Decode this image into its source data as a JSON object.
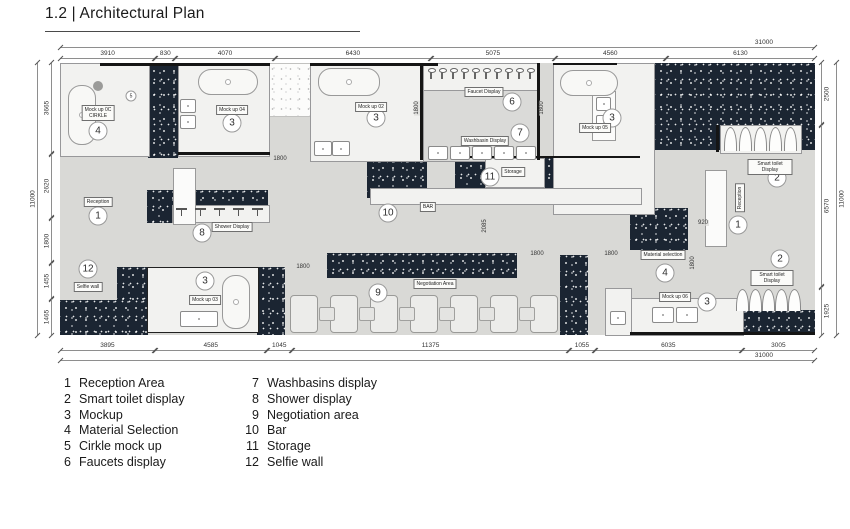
{
  "title": "1.2 | Architectural Plan",
  "colors": {
    "dark_fill": "#1b2532",
    "room_fill": "#f2f2f0",
    "corridor_fill": "#d9d9d6"
  },
  "dimensions": {
    "top": {
      "total": "31000",
      "segments": [
        {
          "label": "3910",
          "mm": 3910
        },
        {
          "label": "830",
          "mm": 830
        },
        {
          "label": "4070",
          "mm": 4070
        },
        {
          "label": "6430",
          "mm": 6430
        },
        {
          "label": "5075",
          "mm": 5075
        },
        {
          "label": "4560",
          "mm": 4560
        },
        {
          "label": "6130",
          "mm": 6130
        }
      ]
    },
    "bottom": {
      "total": "31000",
      "segments": [
        {
          "label": "3895",
          "mm": 3895
        },
        {
          "label": "4585",
          "mm": 4585
        },
        {
          "label": "1045",
          "mm": 1045
        },
        {
          "label": "11375",
          "mm": 11375
        },
        {
          "label": "1055",
          "mm": 1055
        },
        {
          "label": "6035",
          "mm": 6035
        },
        {
          "label": "3005",
          "mm": 3005
        }
      ]
    },
    "left": {
      "total": "11000",
      "segments": [
        {
          "label": "3665",
          "mm": 3665
        },
        {
          "label": "2620",
          "mm": 2620
        },
        {
          "label": "1800",
          "mm": 1800
        },
        {
          "label": "1455",
          "mm": 1455
        },
        {
          "label": "1465",
          "mm": 1465
        }
      ]
    },
    "right": {
      "total": "11000",
      "segments": [
        {
          "label": "2500",
          "mm": 2500
        },
        {
          "label": "6570",
          "mm": 6570
        },
        {
          "label": "1925",
          "mm": 1925
        }
      ]
    }
  },
  "plan_annotations": {
    "markers": [
      {
        "num": "4",
        "x": 38,
        "y": 68
      },
      {
        "num": "5",
        "x": 71,
        "y": 33,
        "small": true
      },
      {
        "num": "3",
        "x": 172,
        "y": 60
      },
      {
        "num": "3",
        "x": 316,
        "y": 55
      },
      {
        "num": "6",
        "x": 452,
        "y": 39
      },
      {
        "num": "7",
        "x": 460,
        "y": 70
      },
      {
        "num": "11",
        "x": 430,
        "y": 114
      },
      {
        "num": "10",
        "x": 328,
        "y": 150
      },
      {
        "num": "3",
        "x": 552,
        "y": 55
      },
      {
        "num": "2",
        "x": 717,
        "y": 115
      },
      {
        "num": "1",
        "x": 678,
        "y": 162
      },
      {
        "num": "2",
        "x": 720,
        "y": 196
      },
      {
        "num": "4",
        "x": 605,
        "y": 210
      },
      {
        "num": "3",
        "x": 647,
        "y": 239
      },
      {
        "num": "1",
        "x": 38,
        "y": 153
      },
      {
        "num": "8",
        "x": 142,
        "y": 170
      },
      {
        "num": "12",
        "x": 28,
        "y": 206
      },
      {
        "num": "9",
        "x": 318,
        "y": 230
      },
      {
        "num": "3",
        "x": 145,
        "y": 218
      }
    ],
    "room_labels": [
      {
        "text": "Mock up 0C\nCIRKLE",
        "x": 38,
        "y": 50
      },
      {
        "text": "Mock up 04",
        "x": 172,
        "y": 47
      },
      {
        "text": "Mock up 02",
        "x": 311,
        "y": 44
      },
      {
        "text": "Faucet Display",
        "x": 424,
        "y": 29
      },
      {
        "text": "Washbasin Display",
        "x": 425,
        "y": 78
      },
      {
        "text": "Storage",
        "x": 453,
        "y": 109
      },
      {
        "text": "BAR",
        "x": 368,
        "y": 144
      },
      {
        "text": "Mock up 05",
        "x": 535,
        "y": 65
      },
      {
        "text": "Smart toilet Display",
        "x": 710,
        "y": 104
      },
      {
        "text": "Smart toilet Display",
        "x": 712,
        "y": 215
      },
      {
        "text": "Material selection",
        "x": 603,
        "y": 192
      },
      {
        "text": "Mock up 06",
        "x": 615,
        "y": 234
      },
      {
        "text": "Reception",
        "x": 38,
        "y": 139
      },
      {
        "text": "Shower Display",
        "x": 172,
        "y": 164
      },
      {
        "text": "Selfie wall",
        "x": 28,
        "y": 224
      },
      {
        "text": "Negotiation Area",
        "x": 375,
        "y": 221
      },
      {
        "text": "Mock up 03",
        "x": 145,
        "y": 237
      },
      {
        "text": "Reception",
        "x": 680,
        "y": 135,
        "vertical": true
      }
    ],
    "inner_dims": [
      {
        "text": "1800",
        "x": 220,
        "y": 96
      },
      {
        "text": "1800",
        "x": 357,
        "y": 45,
        "vertical": true
      },
      {
        "text": "1800",
        "x": 482,
        "y": 45,
        "vertical": true
      },
      {
        "text": "2085",
        "x": 425,
        "y": 163,
        "vertical": true
      },
      {
        "text": "1800",
        "x": 243,
        "y": 204
      },
      {
        "text": "1800",
        "x": 477,
        "y": 191
      },
      {
        "text": "1800",
        "x": 551,
        "y": 191
      },
      {
        "text": "920",
        "x": 643,
        "y": 160
      },
      {
        "text": "1800",
        "x": 633,
        "y": 200,
        "vertical": true
      }
    ]
  },
  "legend": {
    "columns": [
      [
        {
          "num": "1",
          "label": "Reception Area"
        },
        {
          "num": "2",
          "label": "Smart toilet display"
        },
        {
          "num": "3",
          "label": "Mockup"
        },
        {
          "num": "4",
          "label": "Material Selection"
        },
        {
          "num": "5",
          "label": "Cirkle mock up"
        },
        {
          "num": "6",
          "label": "Faucets display"
        }
      ],
      [
        {
          "num": "7",
          "label": "Washbasins display"
        },
        {
          "num": "8",
          "label": "Shower display"
        },
        {
          "num": "9",
          "label": "Negotiation area"
        },
        {
          "num": "10",
          "label": "Bar"
        },
        {
          "num": "11",
          "label": "Storage"
        },
        {
          "num": "12",
          "label": "Selfie wall"
        }
      ]
    ]
  }
}
